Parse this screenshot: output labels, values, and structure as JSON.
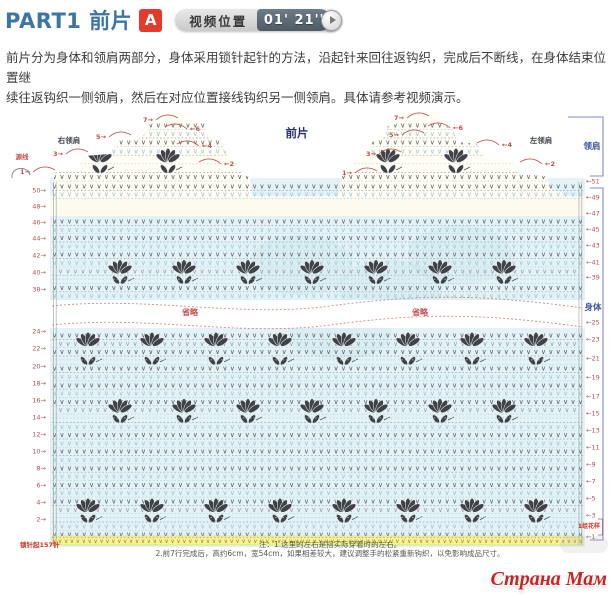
{
  "header": {
    "title": "PART1 前片",
    "badge": "A",
    "video_label": "视频位置",
    "video_time": "01' 21''"
  },
  "intro": {
    "line1": "前片分为身体和领肩两部分，身体采用锁针起针的方法，沿起针来回往返钩织，完成后不断线，在身体结束位置继",
    "line2": "续往返钩织一侧领肩，然后在对应位置接线钩织另一侧领肩。具体请参考视频演示。"
  },
  "notes": {
    "line1": "注：1.这里的左右是指实际穿着时的左右。",
    "line2": "2.前7行完成后，高约6cm，宽54cm，如果相差较大，建议调整手的松紧重新钩织，以免影响成品尺寸。"
  },
  "watermark": {
    "text": "Страна Мам"
  },
  "diagram": {
    "type": "crochet-chart",
    "labels": [
      {
        "text": "前片",
        "x": 297,
        "y": 137,
        "fill": "#23306a",
        "anchor": "middle",
        "size": 11.5,
        "bold": true
      },
      {
        "text": "右领肩",
        "x": 69,
        "y": 143,
        "fill": "#44474f",
        "anchor": "middle",
        "size": 7.5,
        "bold": true
      },
      {
        "text": "左领肩",
        "x": 541,
        "y": 143,
        "fill": "#44474f",
        "anchor": "middle",
        "size": 7.5,
        "bold": true
      },
      {
        "text": "领肩",
        "x": 592,
        "y": 149,
        "fill": "#3d55a5",
        "anchor": "middle",
        "size": 8.5,
        "bold": true
      },
      {
        "text": "身体",
        "x": 593,
        "y": 310,
        "fill": "#3d55a5",
        "anchor": "middle",
        "size": 8.5,
        "bold": true
      },
      {
        "text": "省略",
        "x": 190,
        "y": 315,
        "fill": "#c0504d",
        "anchor": "middle",
        "size": 8,
        "bold": true
      },
      {
        "text": "省略",
        "x": 420,
        "y": 315,
        "fill": "#c0504d",
        "anchor": "middle",
        "size": 8,
        "bold": true
      },
      {
        "text": "源线",
        "x": 22,
        "y": 159,
        "fill": "#c0504d",
        "anchor": "middle",
        "size": 6.5,
        "bold": true
      },
      {
        "text": "锁针起157针",
        "x": 20,
        "y": 547,
        "fill": "#cc3322",
        "anchor": "start",
        "size": 6.5,
        "bold": true
      },
      {
        "text": "1组花样",
        "x": 600,
        "y": 528,
        "fill": "#cc3322",
        "anchor": "end",
        "size": 6,
        "bold": true
      },
      {
        "text": "←1",
        "y": 539,
        "x": 586,
        "fill": "#b05050",
        "anchor": "start",
        "size": 6.5,
        "bold": false
      }
    ],
    "left_numbers": [
      {
        "t": "50→",
        "y": 190
      },
      {
        "t": "48→",
        "y": 206
      },
      {
        "t": "46→",
        "y": 222
      },
      {
        "t": "44→",
        "y": 238
      },
      {
        "t": "42→",
        "y": 255
      },
      {
        "t": "40→",
        "y": 272
      },
      {
        "t": "38→",
        "y": 289
      },
      {
        "t": "24→",
        "y": 331
      },
      {
        "t": "22→",
        "y": 348
      },
      {
        "t": "20→",
        "y": 366
      },
      {
        "t": "18→",
        "y": 383
      },
      {
        "t": "16→",
        "y": 400
      },
      {
        "t": "14→",
        "y": 417
      },
      {
        "t": "12→",
        "y": 434
      },
      {
        "t": "10→",
        "y": 451
      },
      {
        "t": "8→",
        "y": 468
      },
      {
        "t": "6→",
        "y": 485
      },
      {
        "t": "4→",
        "y": 502
      },
      {
        "t": "2→",
        "y": 519
      }
    ],
    "right_numbers": [
      {
        "t": "←51",
        "y": 181
      },
      {
        "t": "←49",
        "y": 197
      },
      {
        "t": "←47",
        "y": 213
      },
      {
        "t": "←45",
        "y": 229
      },
      {
        "t": "←43",
        "y": 245
      },
      {
        "t": "←41",
        "y": 262
      },
      {
        "t": "←39",
        "y": 277
      },
      {
        "t": "←25",
        "y": 322
      },
      {
        "t": "←23",
        "y": 339
      },
      {
        "t": "←21",
        "y": 358
      },
      {
        "t": "←19",
        "y": 377
      },
      {
        "t": "←17",
        "y": 396
      },
      {
        "t": "←15",
        "y": 413
      },
      {
        "t": "←13",
        "y": 430
      },
      {
        "t": "←11",
        "y": 447
      },
      {
        "t": "←9",
        "y": 464
      },
      {
        "t": "←7",
        "y": 481
      },
      {
        "t": "←5",
        "y": 498
      },
      {
        "t": "←3",
        "y": 515
      }
    ],
    "shoulder_annotations": [
      {
        "t": "1→",
        "x": 25,
        "y": 172
      },
      {
        "t": "3→",
        "x": 58,
        "y": 154
      },
      {
        "t": "5→",
        "x": 101,
        "y": 137
      },
      {
        "t": "7→",
        "x": 148,
        "y": 120
      },
      {
        "t": "←6",
        "x": 195,
        "y": 129
      },
      {
        "t": "←4",
        "x": 207,
        "y": 146
      },
      {
        "t": "←2",
        "x": 229,
        "y": 164
      },
      {
        "t": "1→",
        "x": 347,
        "y": 173
      },
      {
        "t": "3→",
        "x": 371,
        "y": 154
      },
      {
        "t": "5→",
        "x": 394,
        "y": 135
      },
      {
        "t": "7→",
        "x": 399,
        "y": 118
      },
      {
        "t": "←6",
        "x": 458,
        "y": 128
      },
      {
        "t": "←4",
        "x": 507,
        "y": 145
      },
      {
        "t": "←2",
        "x": 550,
        "y": 164
      }
    ],
    "geometry": {
      "x0": 52,
      "x1": 583,
      "body_top": 178,
      "body_bottom": 534,
      "cream_stripe": [
        196,
        216
      ],
      "band": [
        300,
        328
      ],
      "sections": [
        {
          "y0": 183,
          "y1": 192,
          "step": 8.2
        },
        {
          "y0": 218,
          "y1": 295,
          "step": 8.3
        },
        {
          "y0": 332,
          "y1": 532,
          "step": 8.3
        }
      ],
      "shoulder_rows": {
        "y0": 122,
        "y1": 176,
        "step": 8.6
      },
      "fan_ys": [
        202,
        267,
        343,
        407,
        506
      ],
      "leaf_ys": [
        212,
        277,
        354,
        416,
        516
      ],
      "shoulder_fan_y": 156,
      "shoulder_leaf_y": 166,
      "shoulder_fan_xs": [
        100,
        168,
        388,
        456
      ],
      "chain_band": [
        536,
        545
      ],
      "right_shoulder": "54,196 54,172 76,170 84,156 110,154 118,140 142,138 150,124 163,122 168,113 186,113 190,121 204,123 210,139 222,141 228,157 238,159 243,175 250,177 252,196",
      "left_shoulder": "338,196 342,176 352,174 356,158 366,156 372,142 382,140 388,126 396,124 400,112 438,112 444,126 452,128 458,142 478,144 486,158 512,160 518,174 546,176 552,190 562,192 562,196"
    },
    "colors": {
      "body_bg": "#e3f2f6",
      "cream": "#fdfbef",
      "v_dark": "#565f6a",
      "v_light": "#9cc6d6",
      "dot_blue": "#aed3de",
      "dot_gray": "#9aa4ab",
      "red": "#c0504d",
      "fan": "#3f4347",
      "chain_bg": "#faf291",
      "chain": "#8b8b3a",
      "shoulder_bg": "#fffdf4",
      "wave": "#cf8d86",
      "bracket": "#7d8fc0",
      "edge": "#8a949b",
      "wm": "#bcd9ea"
    }
  }
}
